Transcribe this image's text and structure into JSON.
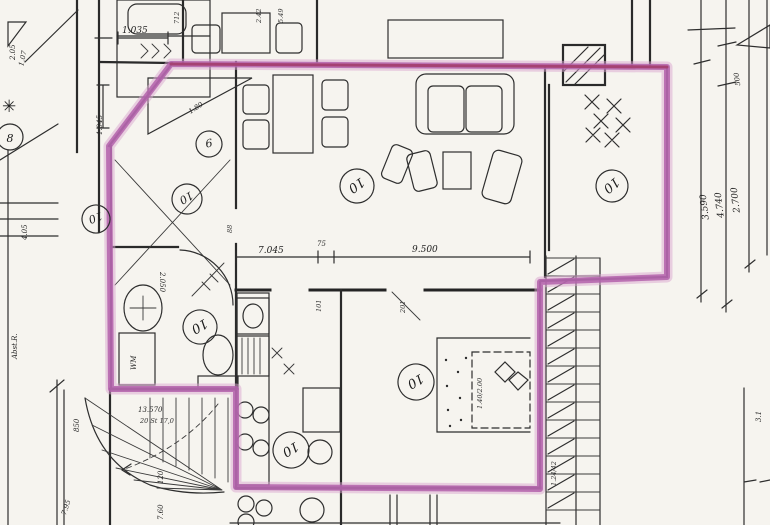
{
  "plan": {
    "description_note": "scanned architectural floor plan with highlighted apartment outline",
    "room_circles": {
      "repeated": "10",
      "eight": "8",
      "nine": "9"
    },
    "dimensions": {
      "top_width": "1.035",
      "top_jog": "1.045",
      "tl_a": "2.05",
      "tl_b": "1.07",
      "t_712": "712",
      "t_242": "2.42",
      "t_549": "5.49",
      "living_width": "7.045",
      "wall_gap": "75",
      "wing_width": "9.500",
      "bath_width": "2.050",
      "right_500": "500",
      "right_2700": "2.700",
      "right_4740": "4.740",
      "right_3590": "3.590",
      "stairs_run": "13.570",
      "stairs_note": "20 St 17,0",
      "stairs_850": "850",
      "stairs_120": "120",
      "stairs_760": "7.60",
      "stairs_795": "7.95",
      "left_405": "4.05",
      "left_note": "Abst.R.",
      "closet": "1.80",
      "door_88": "88",
      "door_101": "101",
      "door_201": "201",
      "bed_size": "1.40/2.00",
      "right_stairs": "1.24/42",
      "bottom_right": "3.1"
    },
    "annotations": {
      "washing_machine": "WM"
    },
    "colors": {
      "highlight": "#b361ab",
      "highlight_glow": "#d9a6d0",
      "highlight_core": "#a43b66",
      "ink": "#242424",
      "paper": "#f6f4ef"
    }
  }
}
